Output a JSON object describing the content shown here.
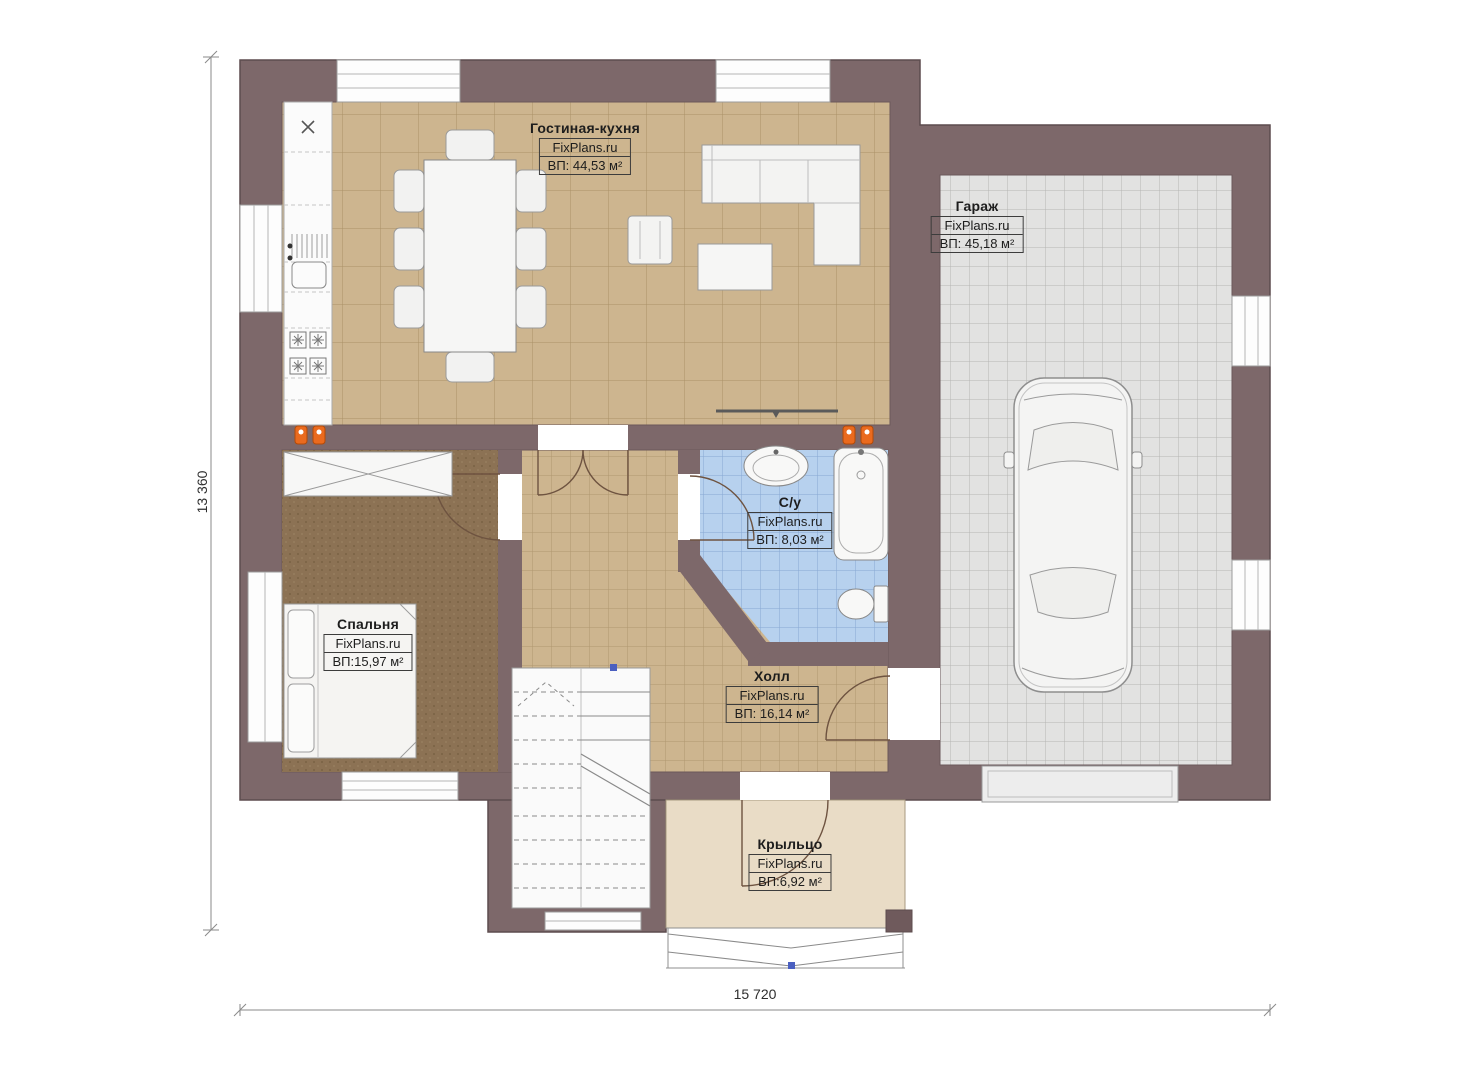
{
  "plan": {
    "watermark": "FixPlans.ru",
    "rooms": [
      {
        "id": "living-kitchen",
        "name": "Гостиная-кухня",
        "site": "FixPlans.ru",
        "area": "ВП: 44,53 м²"
      },
      {
        "id": "garage",
        "name": "Гараж",
        "site": "FixPlans.ru",
        "area": "ВП: 45,18 м²"
      },
      {
        "id": "bedroom",
        "name": "Спальня",
        "site": "FixPlans.ru",
        "area": "ВП:15,97 м²"
      },
      {
        "id": "bathroom",
        "name": "С/у",
        "site": "FixPlans.ru",
        "area": "ВП: 8,03 м²"
      },
      {
        "id": "hall",
        "name": "Холл",
        "site": "FixPlans.ru",
        "area": "ВП: 16,14 м²"
      },
      {
        "id": "porch",
        "name": "Крыльцо",
        "site": "FixPlans.ru",
        "area": "ВП:6,92 м²"
      }
    ],
    "dimensions": {
      "vertical": "13 360",
      "horizontal": "15 720"
    },
    "colors": {
      "wall": "#7d686a",
      "tile_beige": "#cdb58f",
      "carpet_brown": "#8c7254",
      "tile_blue": "#b7d1ee",
      "tile_gray": "#e2e2e1",
      "porch": "#e9dcc6",
      "radiator_orange": "#ea6a1e",
      "marker_blue": "#4a5fc0"
    }
  }
}
